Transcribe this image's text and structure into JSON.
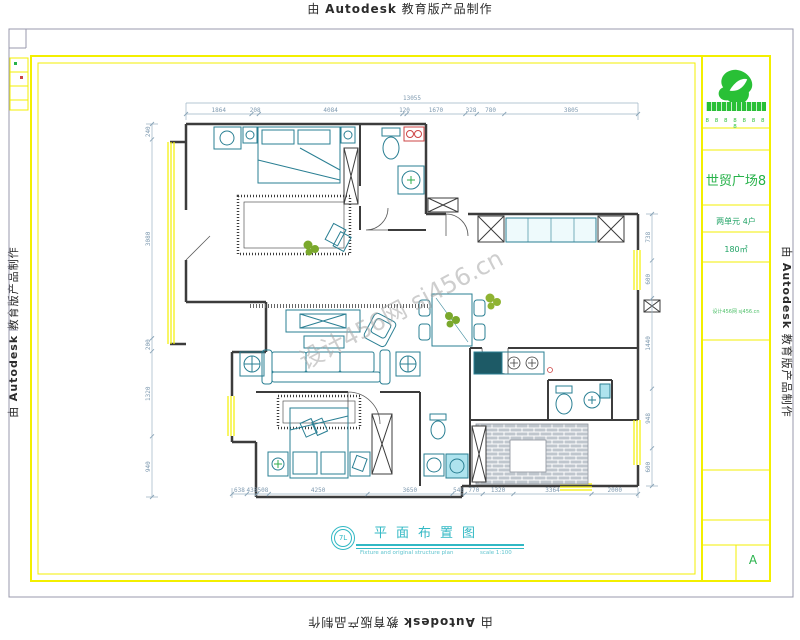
{
  "watermark": {
    "prefix": "由",
    "brand": "Autodesk",
    "suffix": "教育版产品制作"
  },
  "diagonal_watermark": {
    "text": "设计456网 sj456.cn"
  },
  "title_block": {
    "phone_row": "8 8 8 8 8 8 8 8",
    "project": "世贸广场8",
    "unit": "两单元 4户",
    "area": "180㎡",
    "note": "设计456网 sj456.cn",
    "sheet": "A"
  },
  "caption": {
    "bubble": "7L",
    "title": "平面布置图",
    "subtitle": "Fixture and original structure plan",
    "scale": "scale 1:100"
  },
  "dimensions": {
    "top_total": "13055",
    "top": [
      "1864",
      "208",
      "4084",
      "120",
      "1670",
      "328",
      "780",
      "3805"
    ],
    "bottom": [
      "638",
      "438",
      "508",
      "4250",
      "3650",
      "540",
      "770",
      "1320",
      "3364",
      "2000"
    ],
    "left": [
      "240",
      "3080",
      "200",
      "1320",
      "940"
    ],
    "right": [
      "738",
      "600",
      "1440",
      "948",
      "600"
    ]
  }
}
